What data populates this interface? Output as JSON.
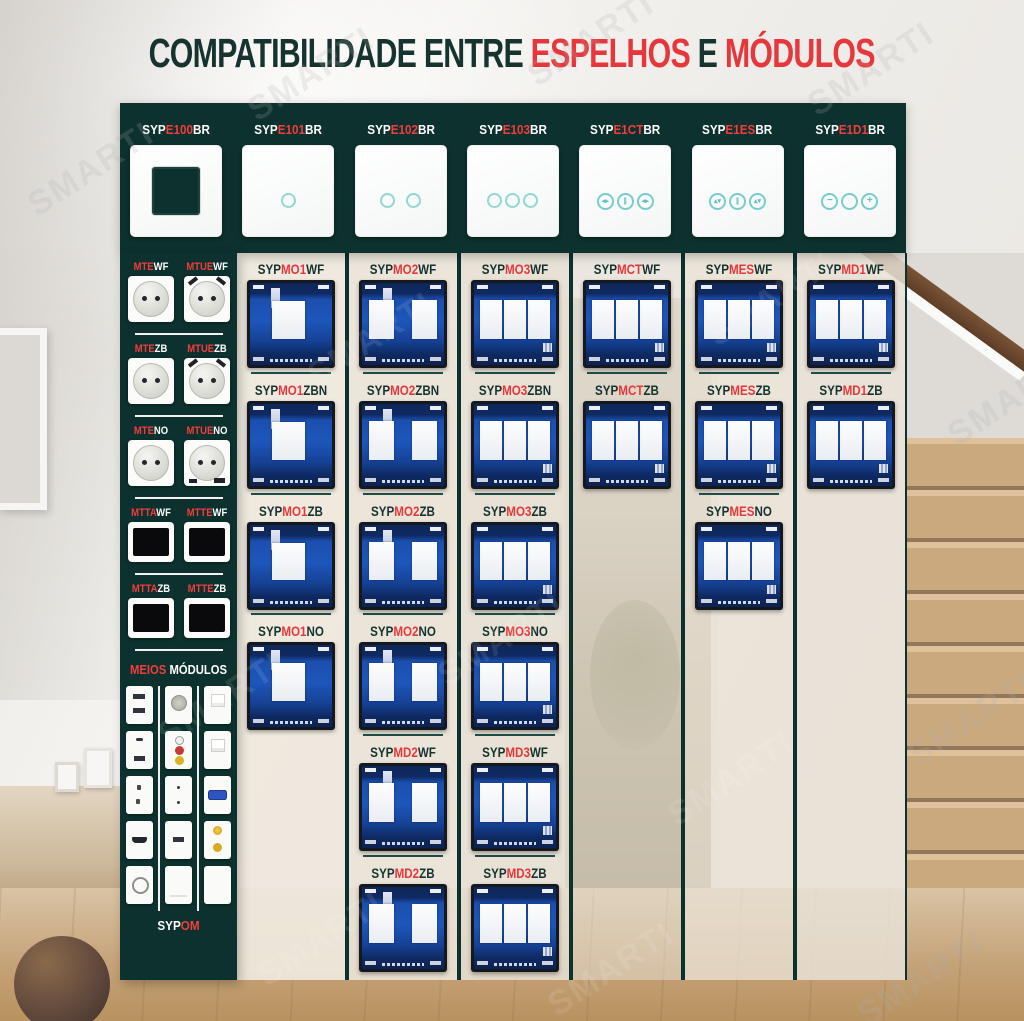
{
  "title": {
    "part1": "COMPATIBILIDADE ENTRE ",
    "highlight1": "ESPELHOS",
    "conj": " E ",
    "highlight2": "MÓDULOS"
  },
  "watermark": {
    "text": "SMARTI"
  },
  "colors": {
    "panel_teal": "#0d312e",
    "accent_red": "#e6383c",
    "label_red_on_dark": "#f23d3d",
    "touch_cyan": "#92d7d6",
    "module_pcb_blue": "#1d56ba",
    "divider_teal": "#1d4c47",
    "column_beige": "#eae3d5"
  },
  "faceplates": [
    {
      "prefix": "SYP",
      "code": "E100",
      "suffix": "BR",
      "kind": "frame"
    },
    {
      "prefix": "SYP",
      "code": "E101",
      "suffix": "BR",
      "kind": "touch-1"
    },
    {
      "prefix": "SYP",
      "code": "E102",
      "suffix": "BR",
      "kind": "touch-2"
    },
    {
      "prefix": "SYP",
      "code": "E103",
      "suffix": "BR",
      "kind": "touch-3"
    },
    {
      "prefix": "SYP",
      "code": "E1CT",
      "suffix": "BR",
      "kind": "curtain"
    },
    {
      "prefix": "SYP",
      "code": "E1ES",
      "suffix": "BR",
      "kind": "shade"
    },
    {
      "prefix": "SYP",
      "code": "E1D1",
      "suffix": "BR",
      "kind": "dimmer"
    }
  ],
  "plate_icons": {
    "curtain": {
      "left": "◂▸",
      "mid": "∥",
      "right": "◂▸"
    },
    "shade": {
      "left": "▴▾",
      "mid": "∥",
      "right": "▴▾"
    },
    "dimmer": {
      "left": "−",
      "mid": "",
      "right": "+"
    }
  },
  "sidebar": {
    "modules": [
      {
        "prefix": "MTE",
        "suffix": "WF",
        "kind": "socket"
      },
      {
        "prefix": "MTUE",
        "suffix": "WF",
        "kind": "socket-usb-top"
      },
      {
        "prefix": "MTE",
        "suffix": "ZB",
        "kind": "socket"
      },
      {
        "prefix": "MTUE",
        "suffix": "ZB",
        "kind": "socket-usb-top"
      },
      {
        "prefix": "MTE",
        "suffix": "NO",
        "kind": "socket"
      },
      {
        "prefix": "MTUE",
        "suffix": "NO",
        "kind": "socket-usb-bottom"
      },
      {
        "prefix": "MTTA",
        "suffix": "WF",
        "kind": "screen"
      },
      {
        "prefix": "MTTE",
        "suffix": "WF",
        "kind": "screen"
      },
      {
        "prefix": "MTTA",
        "suffix": "ZB",
        "kind": "screen"
      },
      {
        "prefix": "MTTE",
        "suffix": "ZB",
        "kind": "screen"
      }
    ],
    "meios_label": {
      "red": "MEIOS",
      "rest": " MÓDULOS"
    },
    "meios_cols": {
      "c1": [
        "usb-double",
        "usb-c",
        "pin2",
        "hdmi",
        "coax"
      ],
      "c2": [
        "tv-round",
        "rca",
        "dots",
        "usb",
        "blank-line"
      ],
      "c3": [
        "rj45",
        "rj45",
        "vga",
        "sat2",
        "blank"
      ]
    },
    "bottom_code": {
      "prefix": "SYP",
      "mid": "OM"
    }
  },
  "columns": [
    {
      "cells": [
        {
          "prefix": "SYP",
          "mid": "MO1",
          "suffix": "WF",
          "kind": "1"
        },
        {
          "prefix": "SYP",
          "mid": "MO1",
          "suffix": "ZBN",
          "kind": "1"
        },
        {
          "prefix": "SYP",
          "mid": "MO1",
          "suffix": "ZB",
          "kind": "1"
        },
        {
          "prefix": "SYP",
          "mid": "MO1",
          "suffix": "NO",
          "kind": "1"
        }
      ]
    },
    {
      "cells": [
        {
          "prefix": "SYP",
          "mid": "MO2",
          "suffix": "WF",
          "kind": "2"
        },
        {
          "prefix": "SYP",
          "mid": "MO2",
          "suffix": "ZBN",
          "kind": "2"
        },
        {
          "prefix": "SYP",
          "mid": "MO2",
          "suffix": "ZB",
          "kind": "2"
        },
        {
          "prefix": "SYP",
          "mid": "MO2",
          "suffix": "NO",
          "kind": "2"
        },
        {
          "prefix": "SYP",
          "mid": "MD2",
          "suffix": "WF",
          "kind": "2"
        },
        {
          "prefix": "SYP",
          "mid": "MD2",
          "suffix": "ZB",
          "kind": "2"
        }
      ]
    },
    {
      "cells": [
        {
          "prefix": "SYP",
          "mid": "MO3",
          "suffix": "WF",
          "kind": "3"
        },
        {
          "prefix": "SYP",
          "mid": "MO3",
          "suffix": "ZBN",
          "kind": "3"
        },
        {
          "prefix": "SYP",
          "mid": "MO3",
          "suffix": "ZB",
          "kind": "3"
        },
        {
          "prefix": "SYP",
          "mid": "MO3",
          "suffix": "NO",
          "kind": "3"
        },
        {
          "prefix": "SYP",
          "mid": "MD3",
          "suffix": "WF",
          "kind": "3"
        },
        {
          "prefix": "SYP",
          "mid": "MD3",
          "suffix": "ZB",
          "kind": "3"
        }
      ]
    },
    {
      "cells": [
        {
          "prefix": "SYP",
          "mid": "MCT",
          "suffix": "WF",
          "kind": "3"
        },
        {
          "prefix": "SYP",
          "mid": "MCT",
          "suffix": "ZB",
          "kind": "3"
        }
      ]
    },
    {
      "cells": [
        {
          "prefix": "SYP",
          "mid": "MES",
          "suffix": "WF",
          "kind": "3"
        },
        {
          "prefix": "SYP",
          "mid": "MES",
          "suffix": "ZB",
          "kind": "3"
        },
        {
          "prefix": "SYP",
          "mid": "MES",
          "suffix": "NO",
          "kind": "3"
        }
      ]
    },
    {
      "cells": [
        {
          "prefix": "SYP",
          "mid": "MD1",
          "suffix": "WF",
          "kind": "3"
        },
        {
          "prefix": "SYP",
          "mid": "MD1",
          "suffix": "ZB",
          "kind": "3"
        }
      ]
    }
  ]
}
